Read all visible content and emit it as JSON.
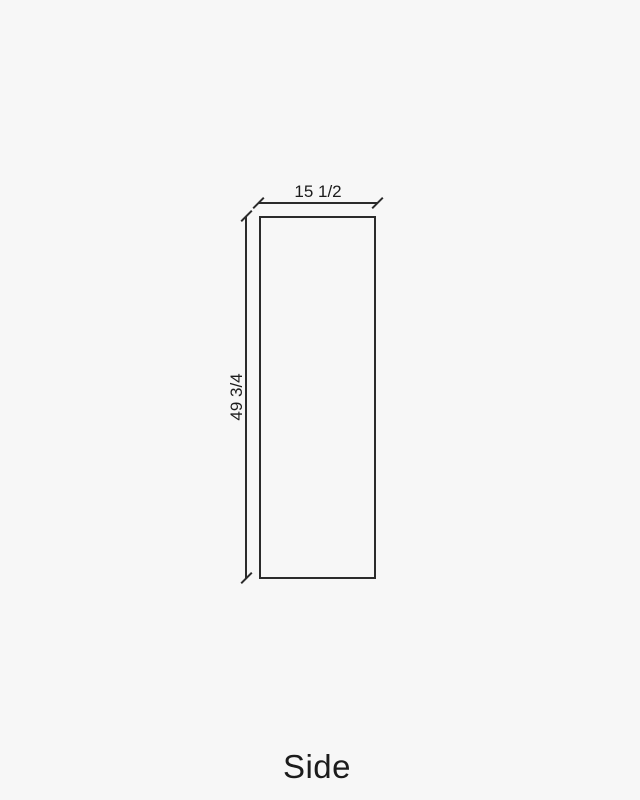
{
  "drawing": {
    "caption": "Side",
    "dimensions": {
      "width_label": "15 1/2",
      "height_label": "49 3/4"
    },
    "colors": {
      "background": "#f7f7f7",
      "line": "#2b2b2b",
      "text": "#1c1c1c"
    }
  }
}
